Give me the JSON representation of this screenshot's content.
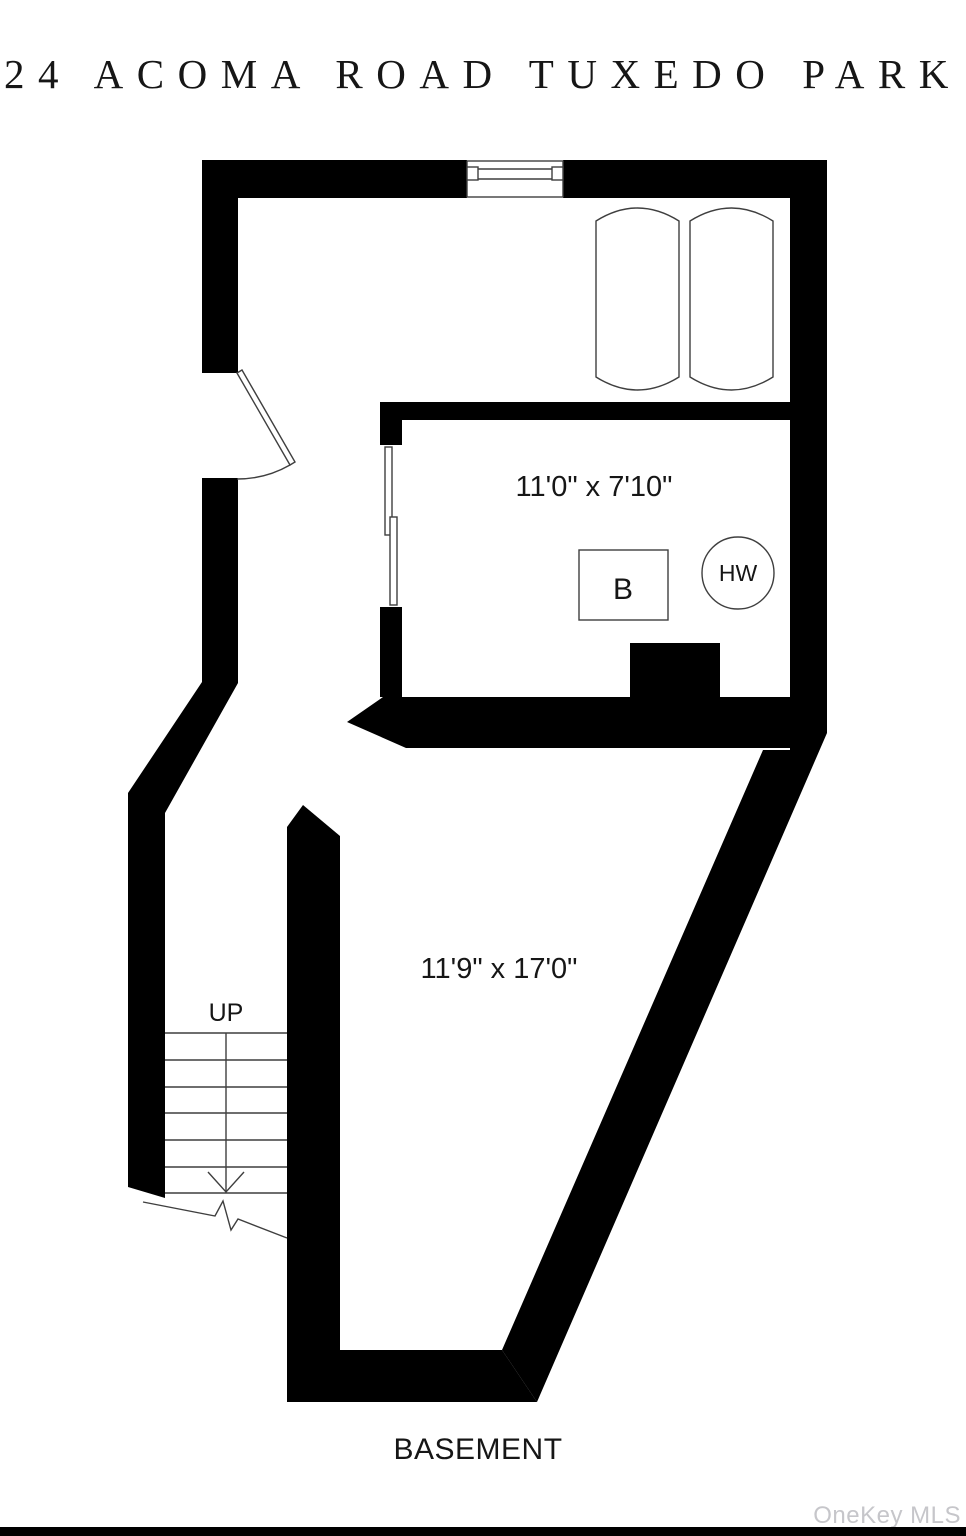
{
  "title": "24 ACOMA ROAD TUXEDO PARK",
  "floorplan": {
    "level_label": "BASEMENT",
    "rooms": [
      {
        "id": "boiler-room",
        "dimensions": "11'0\" x 7'10\""
      },
      {
        "id": "main-room",
        "dimensions": "11'9\" x 17'0\""
      }
    ],
    "fixtures": [
      {
        "id": "boiler",
        "label": "B"
      },
      {
        "id": "hot-water-heater",
        "label": "HW"
      }
    ],
    "stairs": {
      "direction_label": "UP",
      "tread_count": 7
    }
  },
  "watermark": {
    "text": "OneKey MLS"
  },
  "colors": {
    "walls": "#000000",
    "background": "#ffffff",
    "symbol_stroke": "#3f3f3f",
    "label_text": "#161616",
    "watermark_text": "#c6c6ca",
    "bottom_bar": "#000000"
  }
}
